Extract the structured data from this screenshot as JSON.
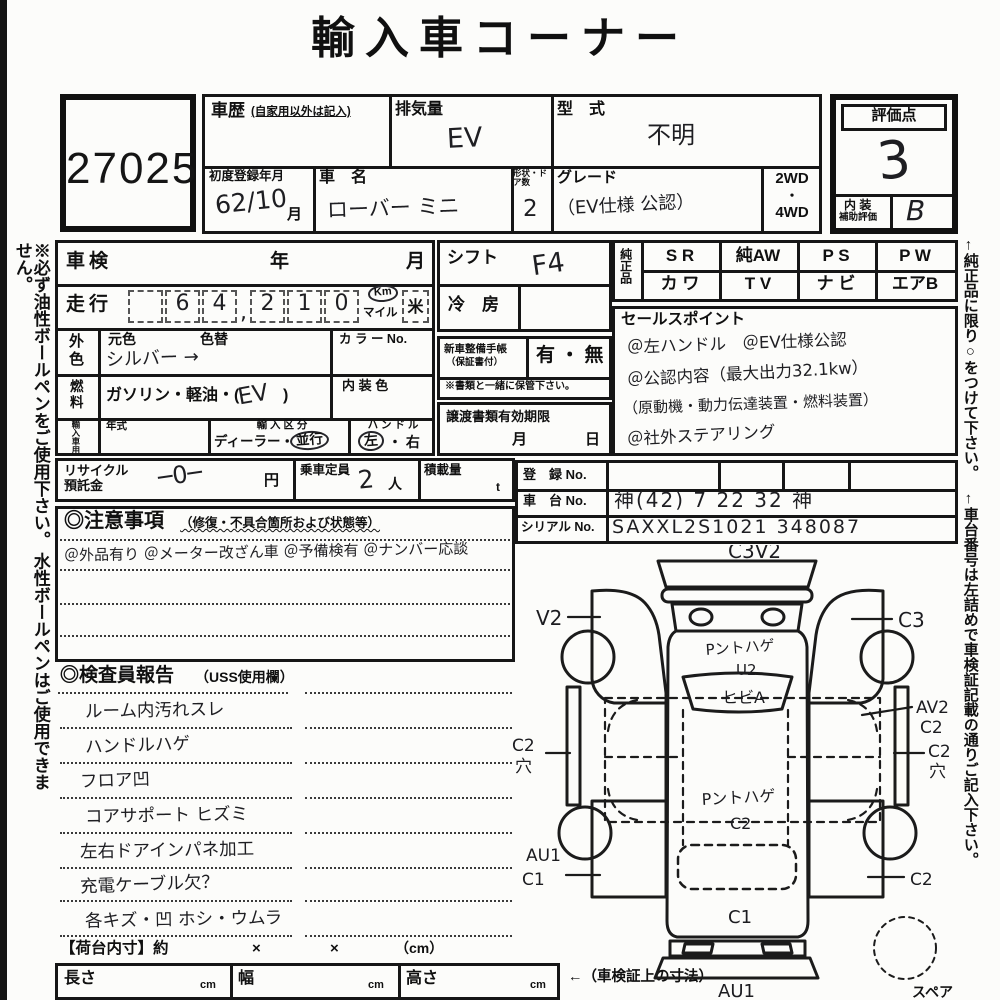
{
  "title": "輸入車コーナー",
  "lot_number": "27025",
  "margin_notes": {
    "left": "※必ず油性ボールペンをご使用下さい。 水性ボールペンはご使用できません。",
    "right": "←純正品に限り○をつけて下さい。　 ←車台番号は左詰めで車検証記載の通りご記入下さい。"
  },
  "header": {
    "history_label": "車歴",
    "history_note": "(自家用以外は記入)",
    "displacement_label": "排気量",
    "displacement_value": "EV",
    "model_label": "型　式",
    "model_value": "不明",
    "first_reg_label": "初度登録年月",
    "first_reg_value": "62/10",
    "month_suffix": "月",
    "car_name_label": "車　名",
    "car_name_value": "ローバー ミニ",
    "doors_label": "形状・ドア数",
    "doors_value": "2",
    "grade_label": "グレード",
    "grade_value": "（EV仕様 公認）",
    "drive_top": "2WD",
    "drive_dot": "・",
    "drive_bottom": "4WD"
  },
  "rating": {
    "label": "評価点",
    "score": "3",
    "interior_label_1": "内 装",
    "interior_label_2": "補助評価",
    "interior_grade": "B"
  },
  "inspection": {
    "shaken_label": "車検",
    "year_label": "年",
    "month_label": "月",
    "mileage_label": "走行",
    "mileage_digits": [
      "",
      "6",
      "4",
      "2",
      "1",
      "0"
    ],
    "mileage_comma": ",",
    "unit_km": "Km",
    "unit_mile": "マイル",
    "unit_bei": "米",
    "ext_color_label": "外色",
    "orig_color_label": "元色",
    "color_change_label": "色替",
    "color_value": "シルバー →",
    "color_no_label": "カ ラ ー No.",
    "fuel_label": "燃料",
    "fuel_printed_pre": "ガソリン・軽油・(",
    "fuel_value": "EV",
    "fuel_printed_post": ")",
    "interior_color_label": "内 装 色",
    "import_label": "輸入車用",
    "year_model_label": "年式",
    "import_class_label": "輸 入 区 分",
    "import_class_pre": "ディーラー・",
    "import_class_circled": "並行",
    "handle_label": "ハ ン ド ル",
    "handle_circled": "左",
    "handle_rest": "・ 右"
  },
  "mid": {
    "shift_label": "シフト",
    "shift_value": "F4",
    "ac_label": "冷　房",
    "techo_label_1": "新車整備手帳",
    "techo_label_2": "（保証書付）",
    "techo_value": "有 ・ 無",
    "keep_note": "※書類と一緒に保管下さい。",
    "transfer_label": "譲渡書類有効期限",
    "transfer_month": "月",
    "transfer_day": "日"
  },
  "genuine": {
    "label": "純正品",
    "row1": [
      "S R",
      "純AW",
      "P S",
      "P W"
    ],
    "row2": [
      "カ ワ",
      "T V",
      "ナ ビ",
      "エアB"
    ]
  },
  "sales_points": {
    "label": "セールスポイント",
    "lines": [
      "＠左ハンドル　＠EV仕様公認",
      "＠公認内容（最大出力32.1kw）",
      "（原動機・動力伝達装置・燃料装置）",
      "＠社外ステアリング"
    ]
  },
  "registration": {
    "reg_label": "登　録 No.",
    "chassis_label": "車　台 No.",
    "chassis_value": "神(42) 7 22 32 神",
    "serial_label": "シリアル No.",
    "serial_value": "SAXXL2S1021 348087"
  },
  "recycle": {
    "label_1": "リサイクル",
    "label_2": "預託金",
    "value": "─0─",
    "yen": "円",
    "capacity_label": "乗車定員",
    "capacity_value": "2",
    "capacity_unit": "人",
    "load_label": "積載量",
    "load_unit": "t"
  },
  "cautions": {
    "heading": "◎注意事項",
    "heading_note": "（修復・不具合箇所および状態等）",
    "line1": "＠外品有り ＠メーター改ざん車 ＠予備検有 ＠ナンバー応談"
  },
  "inspector_report": {
    "heading": "◎検査員報告",
    "heading_note": "（USS使用欄）",
    "items": [
      "ルーム内汚れスレ",
      "ハンドルハゲ",
      "フロア凹",
      "コアサポート ヒズミ",
      "左右ドアインパネ加工",
      "充電ケーブル欠？",
      "各キズ・凹 ホシ・ウムラ"
    ]
  },
  "dimensions": {
    "bed_label": "【荷台内寸】約",
    "x1": "×",
    "x2": "×",
    "cm_note": "（cm）",
    "length_label": "長さ",
    "width_label": "幅",
    "height_label": "高さ",
    "cm": "cm",
    "note": "←（車検証上の寸法）"
  },
  "diagram": {
    "front_top": "C3V2",
    "left_front": "V2",
    "right_front": "C3",
    "hood_text": "Pントハゲ",
    "hood_grade": "U2",
    "windshield_text": "ヒビA",
    "roof_text": "Pントハゲ",
    "roof_grade": "C2",
    "right_side_1": "AV2",
    "right_side_2": "C2",
    "right_hole_1": "C2",
    "right_hole_2": "穴",
    "left_hole_1": "C2",
    "left_hole_2": "穴",
    "left_rear_1": "AU1",
    "left_rear_2": "C1",
    "right_rear": "C2",
    "rear_panel": "C1",
    "rear_bumper": "AU1",
    "spare_label": "スペア"
  }
}
